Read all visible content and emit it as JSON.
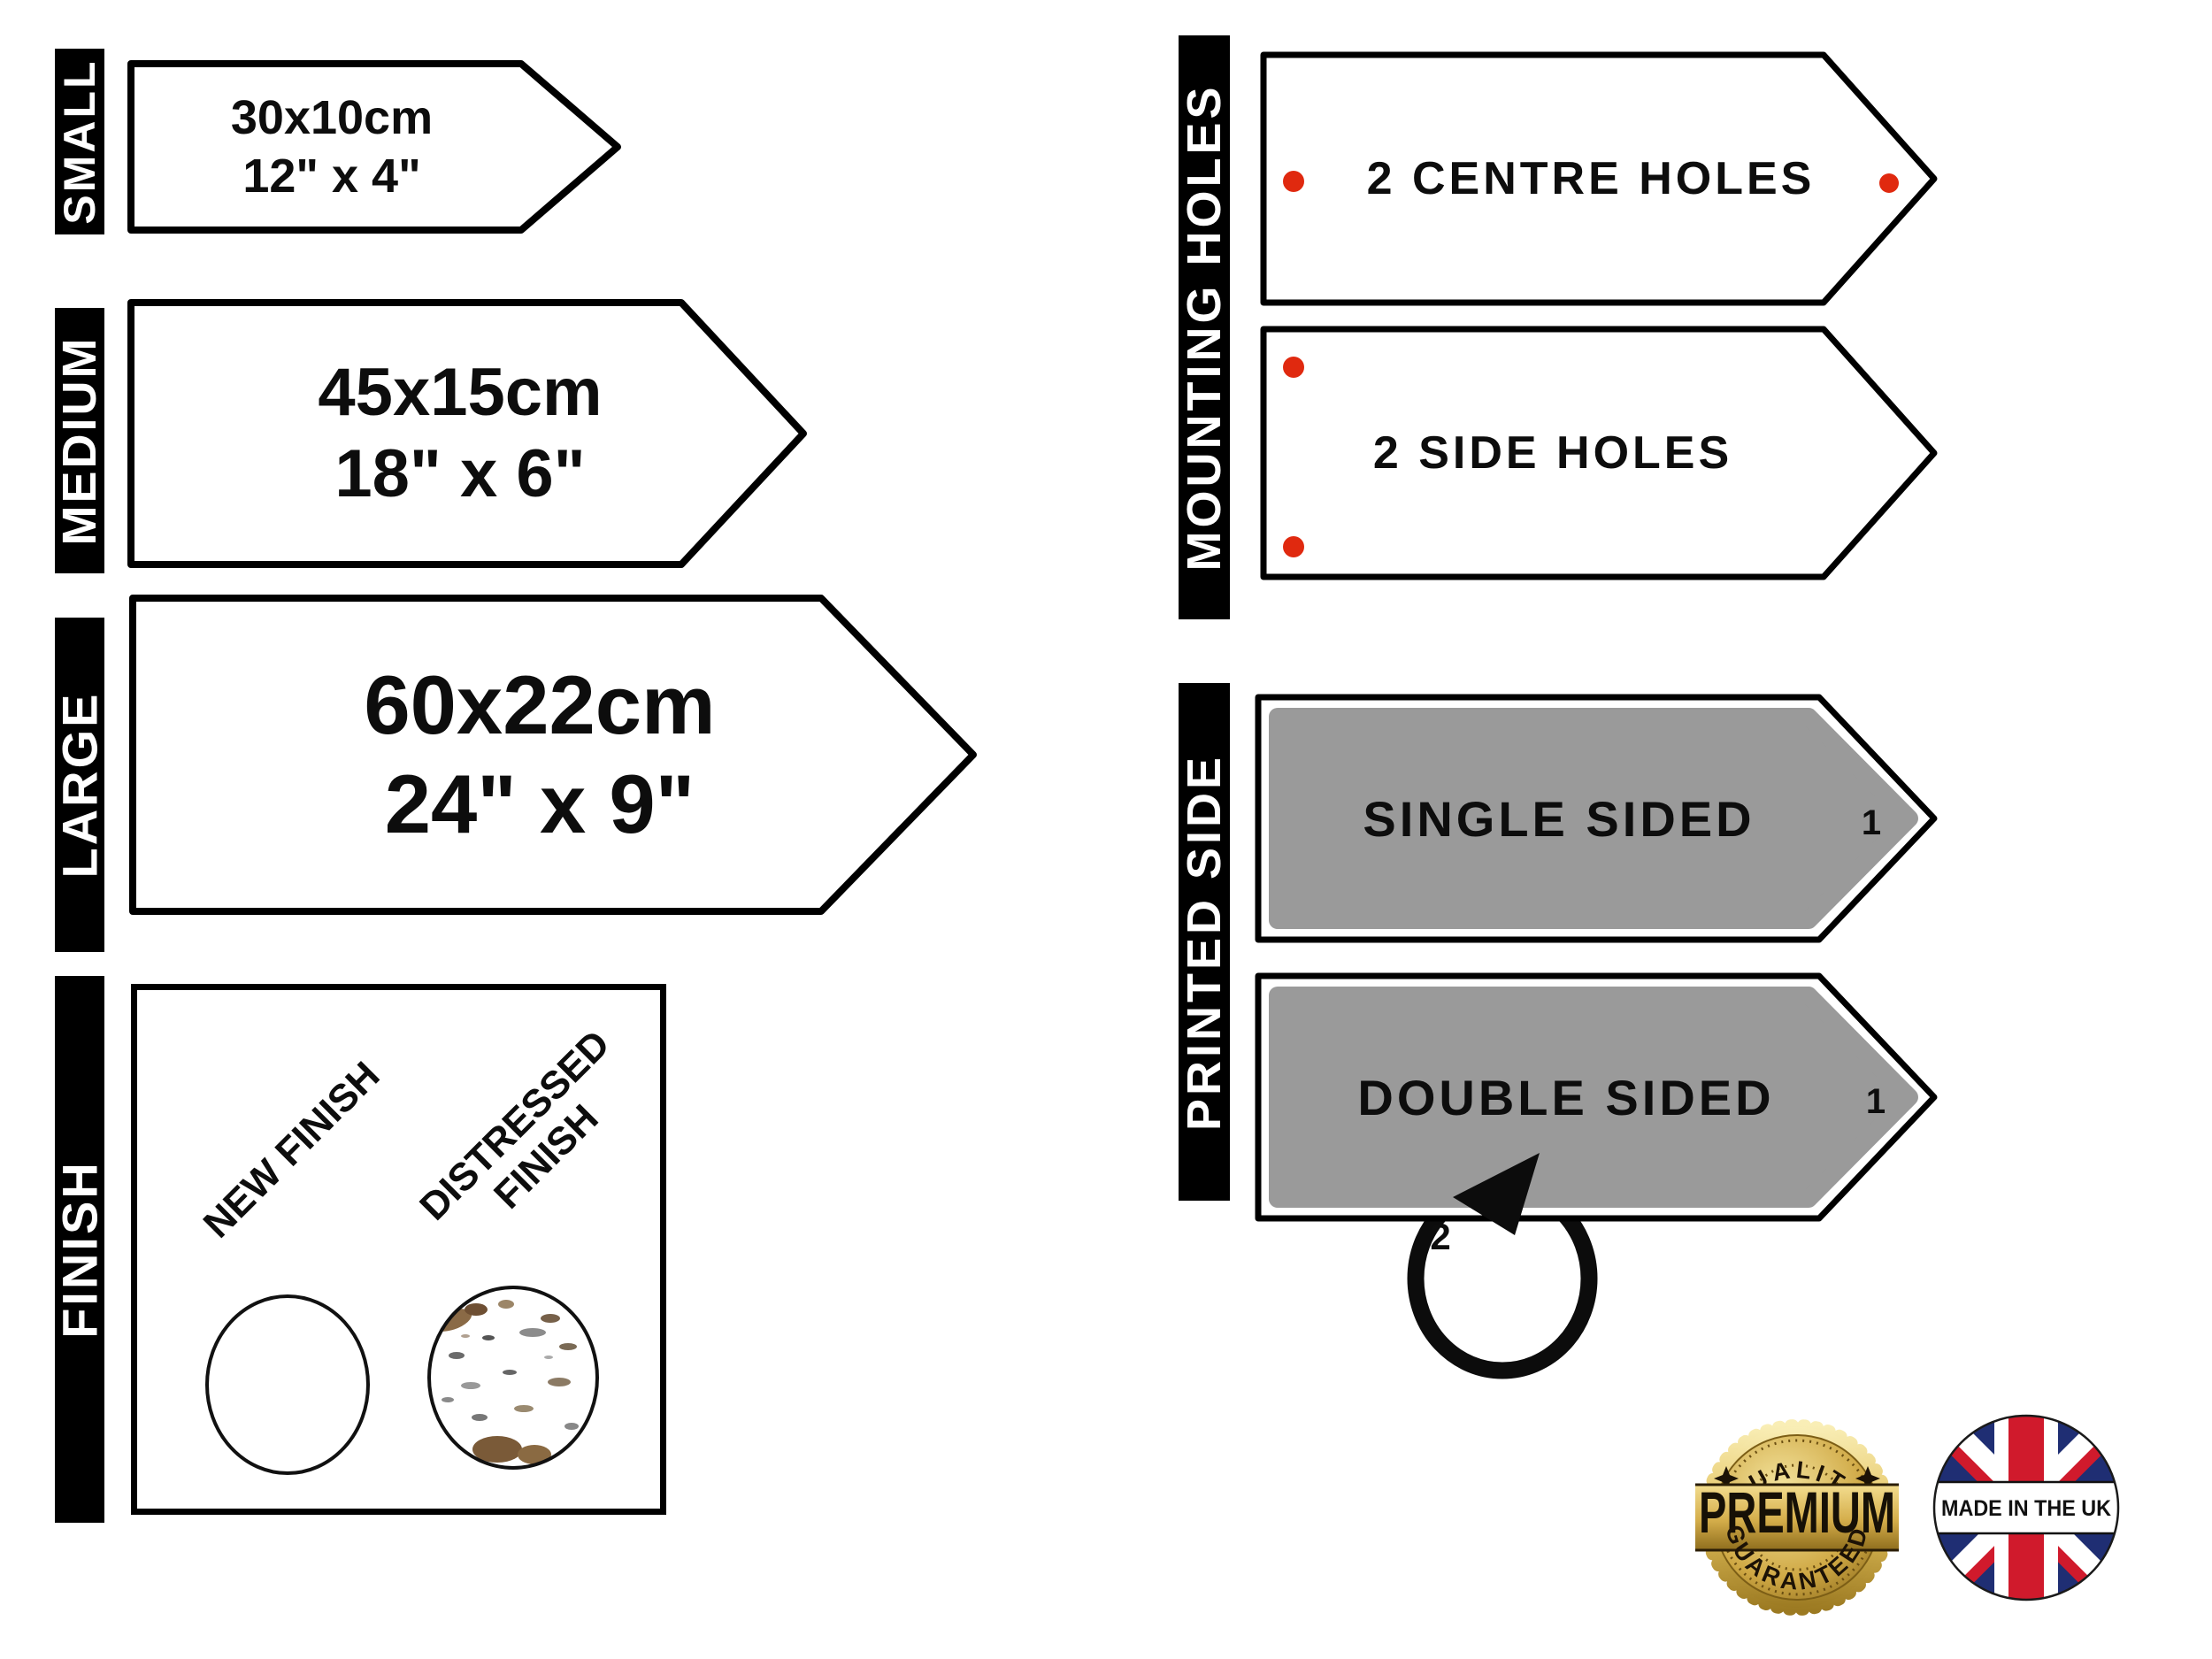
{
  "colors": {
    "hole_dot": "#e0290f",
    "panel_gray": "#9a9a9a",
    "bar_bg": "#000000",
    "bar_text": "#ffffff",
    "flag_blue": "#1f2e73",
    "flag_red": "#d01a2c",
    "gold": "#d4ad4a"
  },
  "size_section": {
    "small": {
      "label": "SMALL",
      "metric": "30x10cm",
      "imperial": "12\" x 4\""
    },
    "medium": {
      "label": "MEDIUM",
      "metric": "45x15cm",
      "imperial": "18\" x 6\""
    },
    "large": {
      "label": "LARGE",
      "metric": "60x22cm",
      "imperial": "24\" x 9\""
    }
  },
  "finish_section": {
    "label": "FINISH",
    "new": "NEW FINISH",
    "distressed_line1": "DISTRESSED",
    "distressed_line2": "FINISH"
  },
  "mounting_section": {
    "label": "MOUNTING HOLES",
    "centre": "2 CENTRE HOLES",
    "side": "2 SIDE HOLES"
  },
  "printed_section": {
    "label": "PRINTED SIDE",
    "single": "SINGLE SIDED",
    "double": "DOUBLE SIDED",
    "front_marker": "1",
    "back_marker": "2"
  },
  "badges": {
    "premium": {
      "arc_top": "QUALITY",
      "center": "PREMIUM",
      "arc_bottom": "GUARANTEED"
    },
    "uk": {
      "label": "MADE IN THE UK"
    }
  }
}
